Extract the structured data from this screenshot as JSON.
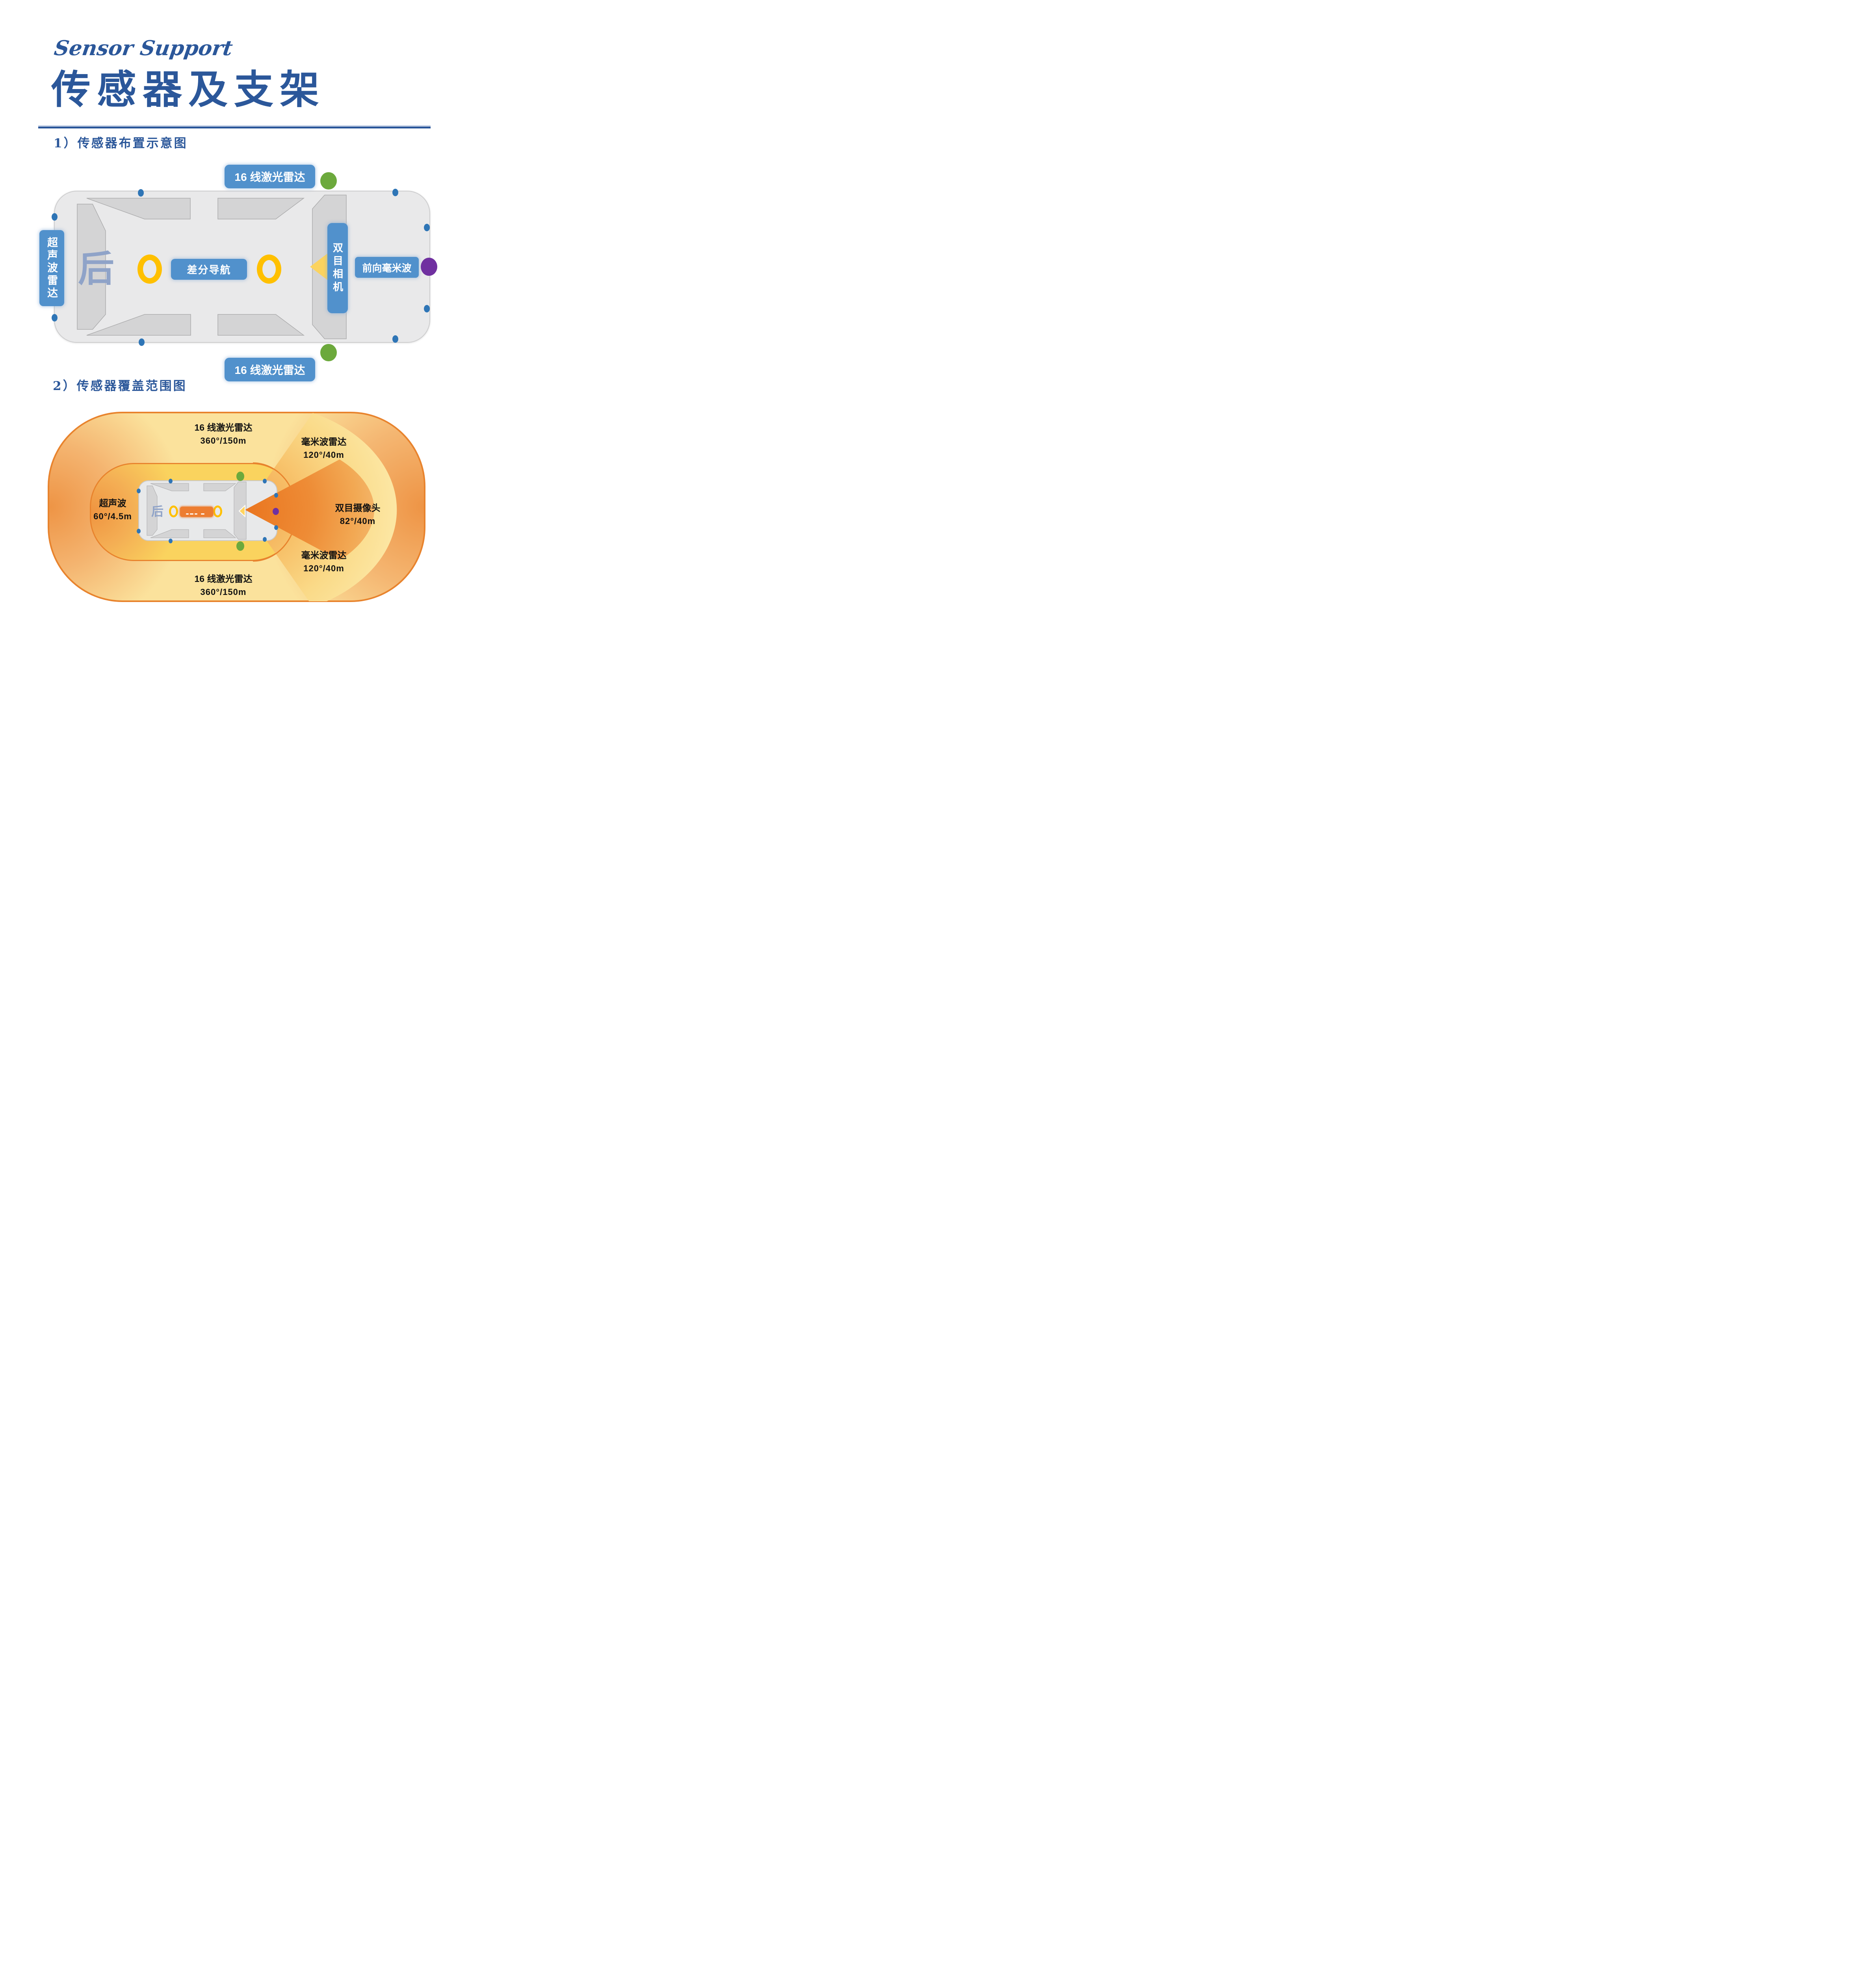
{
  "page": {
    "eyebrow": "Sensor Support",
    "title": "传感器及支架"
  },
  "sections": {
    "layout_heading": "1）传感器布置示意图",
    "coverage_heading": "2）传感器覆盖范围图"
  },
  "layout_diagram": {
    "rear_label": "后",
    "lidar_top": "16 线激光雷达",
    "lidar_bottom": "16 线激光雷达",
    "ultrasonic": "超声波雷达",
    "diff_nav": "差分导航",
    "stereo_camera": "双目相机",
    "front_mmwave": "前向毫米波"
  },
  "coverage_diagram": {
    "rear_label": "后",
    "lidar_top": {
      "name": "16 线激光雷达",
      "spec": "360°/150m"
    },
    "mmwave_top": {
      "name": "毫米波雷达",
      "spec": "120°/40m"
    },
    "ultrasonic": {
      "name": "超声波",
      "spec": "60°/4.5m"
    },
    "binocular": {
      "name": "双目摄像头",
      "spec": "82°/40m"
    },
    "mmwave_bottom": {
      "name": "毫米波雷达",
      "spec": "120°/40m"
    },
    "lidar_bottom": {
      "name": "16 线激光雷达",
      "spec": "360°/150m"
    }
  },
  "colors": {
    "accent_blue": "#2B579A",
    "label_blue": "#5191CC",
    "ring_yellow": "#FFC000",
    "triangle_yellow": "#FFD45F",
    "dot_blue": "#2E75B6",
    "dot_green": "#6CA93C",
    "dot_purple": "#7030A0",
    "nav_orange": "#ED7D31",
    "zone_border_orange": "#E8832D"
  }
}
